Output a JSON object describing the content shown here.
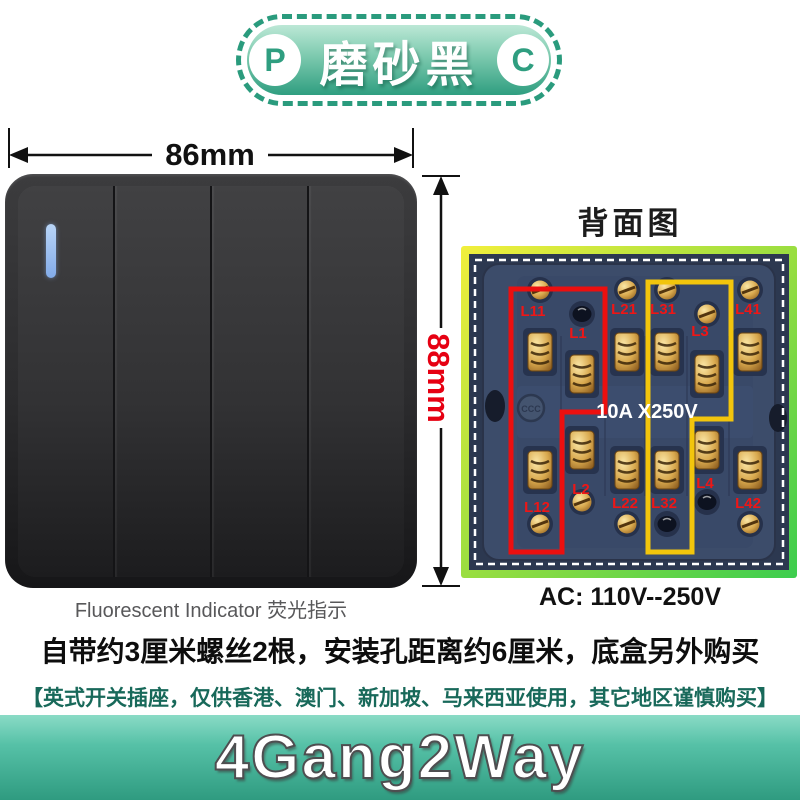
{
  "badge": {
    "left_letter": "P",
    "right_letter": "C",
    "label": "磨砂黑"
  },
  "dimensions": {
    "width": "86mm",
    "height": "88mm"
  },
  "panel": {
    "gang_count": 4,
    "caption_en": "Fluorescent Indicator",
    "caption_zh": "荧光指示"
  },
  "back_view": {
    "title": "背面图",
    "rating": "10A X250V",
    "voltage": "AC: 110V--250V",
    "ccc_mark": "CCC",
    "terminals_top": [
      "L11",
      "L1",
      "L21",
      "L31",
      "L3",
      "L41"
    ],
    "terminals_bottom": [
      "L12",
      "L2",
      "L22",
      "L32",
      "L4",
      "L42"
    ]
  },
  "notes": {
    "install": "自带约3厘米螺丝2根，安装孔距离约6厘米，底盒另外购买",
    "region": "【英式开关插座，仅供香港、澳门、新加坡、马来西亚使用，其它地区谨慎购买】"
  },
  "banner": {
    "title": "4Gang2Way"
  },
  "colors": {
    "badge_teal": "#2f9e80",
    "dimension_red": "#e60012",
    "terminal_label_red": "#ee1616",
    "wiring_highlight_red": "#ec0f0f",
    "wiring_highlight_yellow": "#f2c50c",
    "frame_yellow": "#f2ef3c",
    "frame_green": "#3ccd4e",
    "region_note_green": "#18695a",
    "banner_teal": "#2f9b80",
    "indicator_blue": "#8ab5ec"
  }
}
